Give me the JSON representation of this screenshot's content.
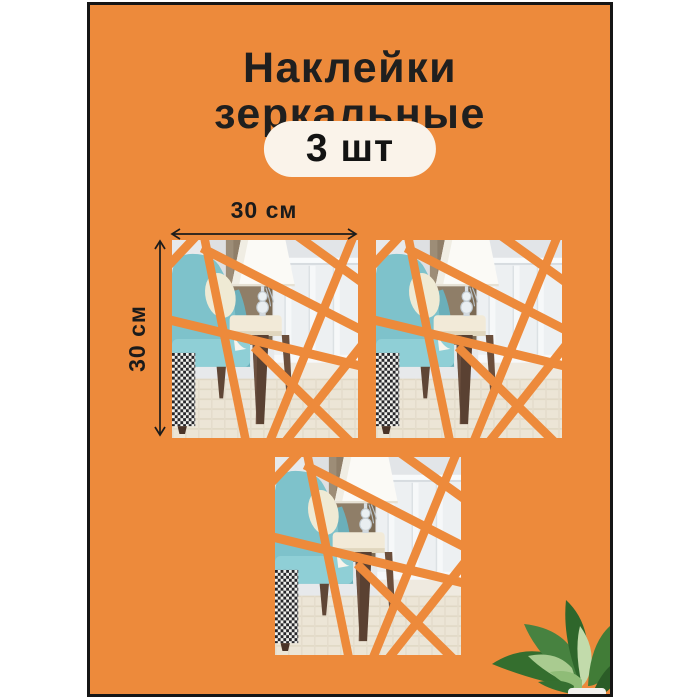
{
  "title": {
    "line1": "Наклейки",
    "line2": "зеркальные"
  },
  "badge": {
    "text": "3 шт"
  },
  "dimensions": {
    "width_label": "30 см",
    "height_label": "30 см"
  },
  "tiles": {
    "count": 3,
    "description": "square mirror sticker set shown over interior photo with orange triangular shard gaps"
  },
  "icons": {
    "width_arrow": "double-arrow-horizontal",
    "height_arrow": "double-arrow-vertical",
    "plant": "dieffenbachia-plant"
  },
  "colors": {
    "page_background": "#FFFFFF",
    "card_orange": "#ED8A3B",
    "card_border": "#151515",
    "badge_background": "#FAF3EA",
    "text_dark": "#1F1F1F",
    "chair_teal": "#7EC2CB",
    "plant_green": "#3A7438"
  }
}
